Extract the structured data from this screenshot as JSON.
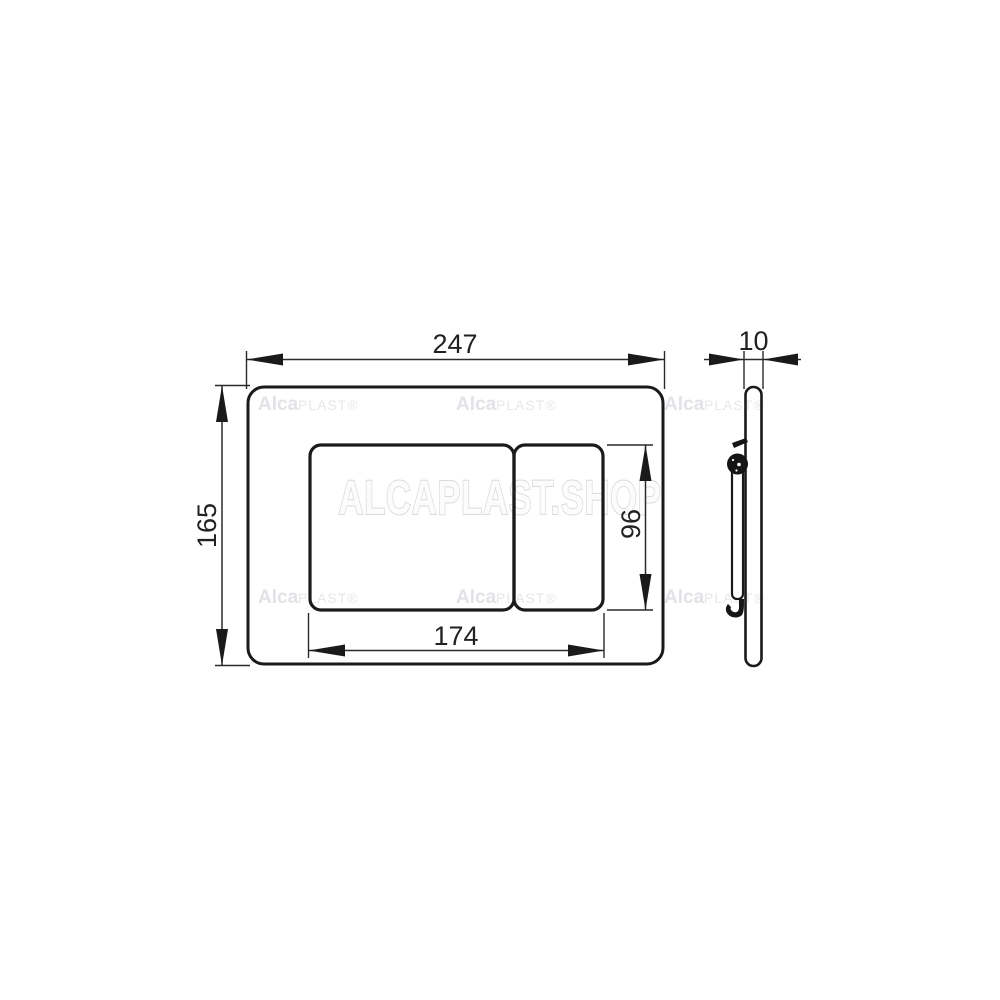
{
  "drawing": {
    "front_view": {
      "width_label": "247",
      "height_label": "165",
      "buttons_width_label": "174",
      "buttons_height_label": "96"
    },
    "side_view": {
      "thickness_label": "10"
    }
  },
  "watermarks": {
    "brand_bold": "Alca",
    "brand_suffix": "PLAST®",
    "shop": "ALCAPLAST.SHOP"
  },
  "colors": {
    "background": "#ffffff",
    "line": "#1a1a1a",
    "dimension_text": "#222222",
    "watermark_fill": "#fcfcfc",
    "watermark_stroke": "#dadada",
    "watermark_small": "#e3e3e7"
  }
}
